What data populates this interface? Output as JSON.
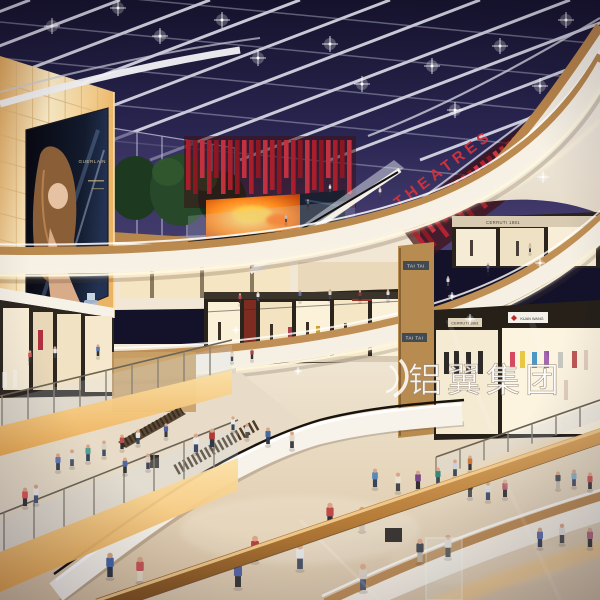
{
  "meta": {
    "title": "Shopping mall atrium interior rendering, night scene"
  },
  "signs": {
    "theatres": {
      "label": "THEATRES",
      "color": "#c93340"
    },
    "tai_tai_upper": {
      "label": "TAI TAI"
    },
    "tai_tai_lower": {
      "label": "TAI TAI"
    },
    "cerruti_upper": {
      "label": "CERRUTI 1881"
    },
    "cerruti_lower": {
      "label": "CERRUTI 1881"
    },
    "kuan_wang": {
      "label": "KUAN WANG"
    },
    "guerlain": {
      "label": "GUERLAIN"
    }
  },
  "watermark": {
    "text": "铝翼集团",
    "color": "#ffffff"
  },
  "palette": {
    "sky_top": "#191634",
    "sky_low": "#4b4276",
    "amber_panel": "#fdeecb",
    "wood": "#bb8a4e",
    "cream": "#f7f1e5",
    "red_slat": "#a91e2b",
    "fire_screen": "#ff8c1f",
    "floor": "#e8dbc5",
    "led": "#fff6da"
  },
  "geometry": {
    "skylight": {
      "rafters": [
        [
          30,
          0,
          -390,
          160
        ],
        [
          120,
          0,
          -300,
          160
        ],
        [
          210,
          0,
          -210,
          160
        ],
        [
          300,
          0,
          -120,
          160
        ],
        [
          390,
          0,
          -30,
          160
        ],
        [
          480,
          0,
          60,
          160
        ],
        [
          570,
          0,
          150,
          160
        ],
        [
          660,
          0,
          240,
          160
        ],
        [
          750,
          0,
          330,
          160
        ],
        [
          840,
          0,
          420,
          160
        ]
      ],
      "purlins": [
        [
          0,
          -14,
          600,
          44
        ],
        [
          0,
          22,
          600,
          80
        ],
        [
          0,
          58,
          600,
          116
        ],
        [
          0,
          94,
          600,
          152
        ],
        [
          0,
          130,
          600,
          188
        ]
      ],
      "lights": [
        [
          52,
          26
        ],
        [
          160,
          36
        ],
        [
          258,
          58
        ],
        [
          362,
          84
        ],
        [
          455,
          110
        ],
        [
          118,
          8
        ],
        [
          222,
          20
        ],
        [
          330,
          44
        ],
        [
          432,
          66
        ],
        [
          540,
          86
        ],
        [
          566,
          20
        ],
        [
          500,
          46
        ]
      ]
    },
    "wallGrid": {
      "cols": 7,
      "rows": 9,
      "top": [
        0,
        56,
        114,
        92
      ],
      "bottom": [
        0,
        292,
        114,
        318
      ]
    },
    "slats": {
      "cinema": {
        "x0": 186,
        "step": 7,
        "count": 24,
        "top": 140,
        "w": 4.6,
        "hA": 38,
        "hB": 54,
        "colors": [
          "#a91e2b",
          "#8c1723",
          "#c23140"
        ]
      },
      "theatres": {
        "x0": 0,
        "step": 8,
        "count": 26,
        "top": 8,
        "w": 4.5,
        "hA": 28,
        "hB": 40,
        "colors": [
          "#b22230",
          "#8e1824",
          "#d03545"
        ]
      }
    },
    "balustrades": [
      {
        "x1": 0,
        "y1": 426,
        "x2": 232,
        "y2": 370,
        "posts": [
          2,
          28,
          54,
          80,
          106,
          132,
          158,
          184,
          210
        ],
        "postH": 30,
        "stripH": 30,
        "glow": true
      },
      {
        "x1": 0,
        "y1": 552,
        "x2": 238,
        "y2": 458,
        "posts": [
          4,
          34,
          64,
          94,
          124,
          154,
          184,
          214
        ],
        "postH": 38,
        "stripH": 40,
        "glow": true
      },
      {
        "x1": 436,
        "y1": 477,
        "x2": 600,
        "y2": 420,
        "posts": [
          436,
          460,
          484,
          508,
          532,
          556,
          580
        ],
        "postH": 20,
        "stripH": 0,
        "glow": false
      }
    ],
    "sparkles": [
      [
        470,
        319,
        5
      ],
      [
        540,
        263,
        5
      ],
      [
        298,
        371,
        4
      ],
      [
        452,
        296,
        4
      ],
      [
        543,
        177,
        6
      ],
      [
        452,
        487,
        7
      ],
      [
        236,
        330,
        4
      ]
    ]
  },
  "people": [
    [
      196,
      452,
      19,
      "#e8e8e8",
      "#3a4a68",
      "low"
    ],
    [
      212,
      447,
      19,
      "#b03838",
      "#303848",
      "low"
    ],
    [
      247,
      438,
      15,
      "#d8d8d8",
      "#555555",
      "low"
    ],
    [
      268,
      444,
      17,
      "#4868a0",
      "#2e3a50",
      "low"
    ],
    [
      292,
      448,
      17,
      "#e0d8c8",
      "#404040",
      "low"
    ],
    [
      330,
      526,
      24,
      "#c04848",
      "#2a3040",
      "low"
    ],
    [
      362,
      530,
      24,
      "#3c3c44",
      "#c8beac",
      "low"
    ],
    [
      375,
      487,
      19,
      "#5888b8",
      "#38445c",
      "low"
    ],
    [
      398,
      491,
      19,
      "#e8e0d0",
      "#484848",
      "low"
    ],
    [
      418,
      489,
      19,
      "#784888",
      "#303030",
      "low"
    ],
    [
      438,
      484,
      17,
      "#388878",
      "#3c485c",
      "low"
    ],
    [
      455,
      476,
      17,
      "#d0d0d8",
      "#404a58",
      "low"
    ],
    [
      470,
      470,
      15,
      "#c87838",
      "#383838",
      "low"
    ],
    [
      255,
      561,
      26,
      "#b84040",
      "#2c3448",
      "low"
    ],
    [
      300,
      569,
      26,
      "#e4e4e4",
      "#3c4458",
      "low"
    ],
    [
      238,
      587,
      27,
      "#4858a0",
      "#282828",
      "low"
    ],
    [
      363,
      590,
      27,
      "#d8cfc0",
      "#44506a",
      "low"
    ],
    [
      420,
      562,
      24,
      "#3a4048",
      "#b8b0a0",
      "low"
    ],
    [
      448,
      557,
      23,
      "#e0dcd4",
      "#3a3a3a",
      "low"
    ],
    [
      110,
      577,
      25,
      "#4868a8",
      "#303848",
      "low"
    ],
    [
      140,
      581,
      25,
      "#c85858",
      "#e0d8c8",
      "low"
    ],
    [
      25,
      506,
      19,
      "#e05858",
      "#383838",
      "low"
    ],
    [
      36,
      503,
      19,
      "#e8e8e8",
      "#4a5a78",
      "low"
    ],
    [
      58,
      470,
      17,
      "#6878b0",
      "#3a4458",
      "low"
    ],
    [
      72,
      466,
      17,
      "#e0e0d8",
      "#505868",
      "low"
    ],
    [
      88,
      461,
      17,
      "#50a090",
      "#3c485c",
      "low"
    ],
    [
      104,
      456,
      16,
      "#d8d0c0",
      "#434f65",
      "low"
    ],
    [
      122,
      449,
      15,
      "#b85050",
      "#303030",
      "low"
    ],
    [
      138,
      444,
      15,
      "#e8e4da",
      "#3e4a60",
      "low"
    ],
    [
      166,
      437,
      14,
      "#5060a0",
      "#383838",
      "low"
    ],
    [
      470,
      497,
      18,
      "#303030",
      "#484848",
      "low"
    ],
    [
      488,
      500,
      19,
      "#d8d8d8",
      "#3a4664",
      "low"
    ],
    [
      505,
      497,
      18,
      "#b85868",
      "#2e2e2e",
      "low"
    ],
    [
      558,
      488,
      17,
      "#4a4a52",
      "#c0b8a8",
      "low"
    ],
    [
      574,
      486,
      17,
      "#88b0c8",
      "#404c62",
      "low"
    ],
    [
      590,
      489,
      17,
      "#d05050",
      "#343434",
      "low"
    ],
    [
      540,
      547,
      20,
      "#5868a8",
      "#303a50",
      "low"
    ],
    [
      562,
      543,
      20,
      "#e0ddd5",
      "#454545",
      "low"
    ],
    [
      590,
      547,
      20,
      "#b06078",
      "#2f2f2f",
      "low"
    ],
    [
      240,
      303,
      10,
      "#c05050",
      "#333333",
      "up"
    ],
    [
      258,
      301,
      10,
      "#e8e8e8",
      "#444455",
      "up"
    ],
    [
      300,
      300,
      10,
      "#5070a8",
      "#333333",
      "up"
    ],
    [
      330,
      299,
      10,
      "#d8d0c0",
      "#444455",
      "up"
    ],
    [
      360,
      300,
      10,
      "#803838",
      "#333333",
      "up"
    ],
    [
      388,
      299,
      10,
      "#e0e0e0",
      "#444455",
      "up"
    ],
    [
      448,
      286,
      10,
      "#d8d8d8",
      "#444455",
      "up"
    ],
    [
      488,
      272,
      9,
      "#5060a0",
      "#333333",
      "up"
    ],
    [
      530,
      252,
      9,
      "#c8c0b0",
      "#444455",
      "up"
    ],
    [
      30,
      362,
      12,
      "#d05858",
      "#333333",
      "up"
    ],
    [
      55,
      358,
      12,
      "#e8e8e8",
      "#444455",
      "up"
    ],
    [
      98,
      356,
      12,
      "#5878b0",
      "#333333",
      "up"
    ],
    [
      232,
      361,
      11,
      "#e0d8c8",
      "#444455",
      "up"
    ],
    [
      252,
      359,
      11,
      "#a04848",
      "#333333",
      "up"
    ],
    [
      233,
      430,
      14,
      "#e8e8e8",
      "#3a4456",
      "low"
    ],
    [
      125,
      473,
      16,
      "#5068a0",
      "#333333",
      "low"
    ],
    [
      148,
      469,
      16,
      "#d8d0c0",
      "#444455",
      "low"
    ],
    [
      330,
      192,
      8,
      "#e0e0e0",
      "#444444",
      "up"
    ],
    [
      308,
      207,
      8,
      "#4868a0",
      "#333333",
      "up"
    ],
    [
      286,
      222,
      8,
      "#c0c0c0",
      "#444444",
      "up"
    ],
    [
      380,
      196,
      9,
      "#d8d8d8",
      "#444455",
      "up"
    ]
  ]
}
